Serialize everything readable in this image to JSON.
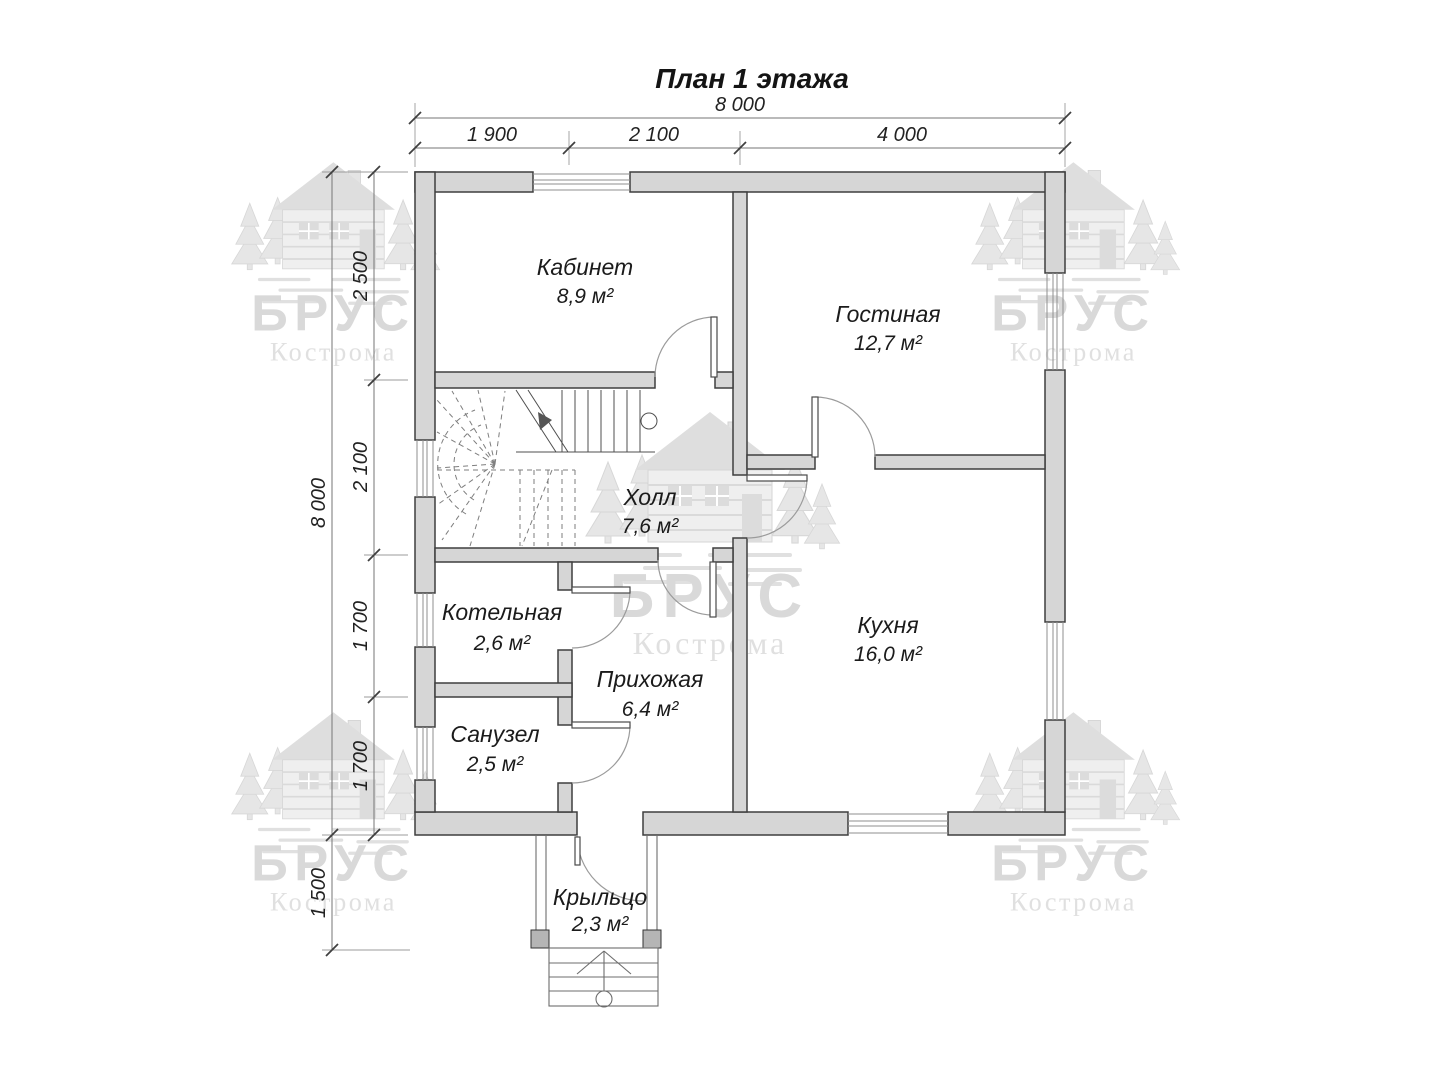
{
  "title": "План 1 этажа",
  "dims": {
    "top": {
      "total": "8 000",
      "segments": [
        "1 900",
        "2 100",
        "4 000"
      ]
    },
    "left": {
      "total": "8 000",
      "segments": [
        "2 500",
        "2 100",
        "1 700",
        "1 700"
      ],
      "porch": "1 500"
    }
  },
  "rooms": [
    {
      "name": "Кабинет",
      "area": "8,9 м²"
    },
    {
      "name": "Гостиная",
      "area": "12,7 м²"
    },
    {
      "name": "Холл",
      "area": "7,6 м²"
    },
    {
      "name": "Котельная",
      "area": "2,6 м²"
    },
    {
      "name": "Кухня",
      "area": "16,0 м²"
    },
    {
      "name": "Прихожая",
      "area": "6,4 м²"
    },
    {
      "name": "Санузел",
      "area": "2,5 м²"
    },
    {
      "name": "Крыльцо",
      "area": "2,3 м²"
    }
  ],
  "watermark": {
    "brand": "БРУС",
    "city": "Кострома"
  },
  "colors": {
    "wall_fill": "#d6d6d6",
    "wall_stroke": "#3f3f3f",
    "dimension_line": "#767676",
    "label_text": "#1b1b1b",
    "watermark": "#dcdcdc"
  }
}
